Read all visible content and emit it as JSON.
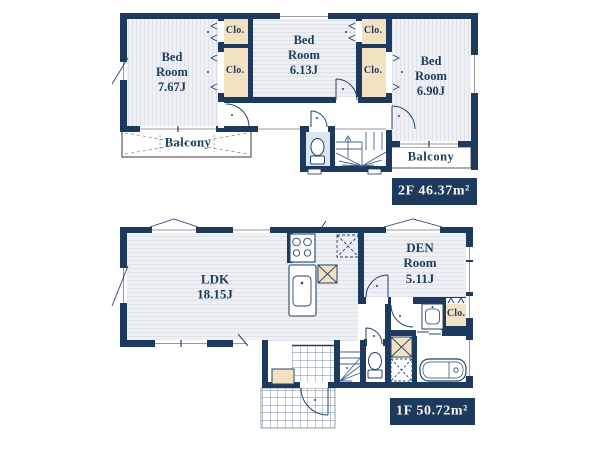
{
  "colors": {
    "wall": "#1d3a5e",
    "closet_fill": "#f2e2c2",
    "toilet_floor": "#d9e7f2",
    "balcony_border": "#5a5a5a",
    "label_box_bg": "#1d3a5e",
    "label_text": "#f7f5ef",
    "text": "#1e3a5c",
    "floor_stripe": "#dfe3e9",
    "floor_base": "#eef0f3"
  },
  "floor2": {
    "rooms": {
      "bed1": "Bed\nRoom\n7.67J",
      "bed2": "Bed\nRoom\n6.13J",
      "bed3": "Bed\nRoom\n6.90J"
    },
    "closets": {
      "a": "Clo.",
      "b": "Clo.",
      "c": "Clo.",
      "d": "Clo."
    },
    "balcony_left": "Balcony",
    "balcony_right": "Balcony",
    "area_label": "2F 46.37m²"
  },
  "floor1": {
    "rooms": {
      "ldk": "LDK\n18.15J",
      "den": "DEN\nRoom\n5.11J"
    },
    "closet": "Clo.",
    "area_label": "1F 50.72m²"
  }
}
